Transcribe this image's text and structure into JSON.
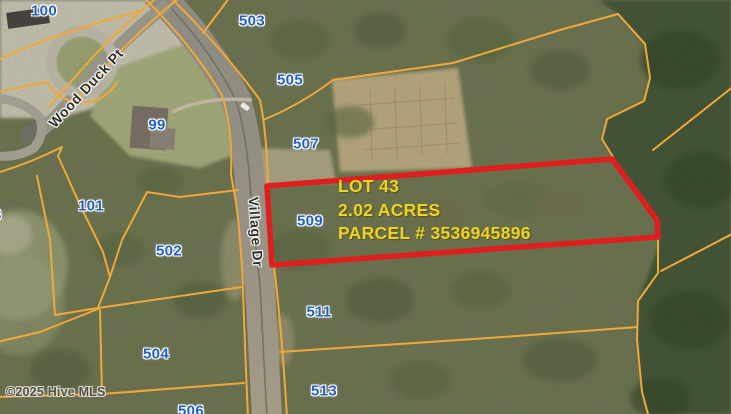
{
  "map": {
    "watermark": "©2025 Hive MLS",
    "streets": {
      "wood_duck": "Wood Duck Pt",
      "village": "Village Dr"
    },
    "lots": [
      {
        "label": "100"
      },
      {
        "label": "503"
      },
      {
        "label": "505"
      },
      {
        "label": "99"
      },
      {
        "label": "507"
      },
      {
        "label": "509"
      },
      {
        "label": "511"
      },
      {
        "label": "513"
      },
      {
        "label": "101"
      },
      {
        "label": "502"
      },
      {
        "label": "504"
      },
      {
        "label": "506"
      },
      {
        "label": "3"
      }
    ],
    "highlight": {
      "lot": "LOT 43",
      "acres": "2.02 ACRES",
      "parcel": "PARCEL # 3536945896"
    },
    "colors": {
      "parcel_line": "#f0a838",
      "highlight_outline": "#e01e1e",
      "highlight_text": "#eed31f",
      "lot_label_blue": "#2260c8",
      "forest_dark": "#3f5136",
      "forest_base": "#6d7052"
    }
  }
}
